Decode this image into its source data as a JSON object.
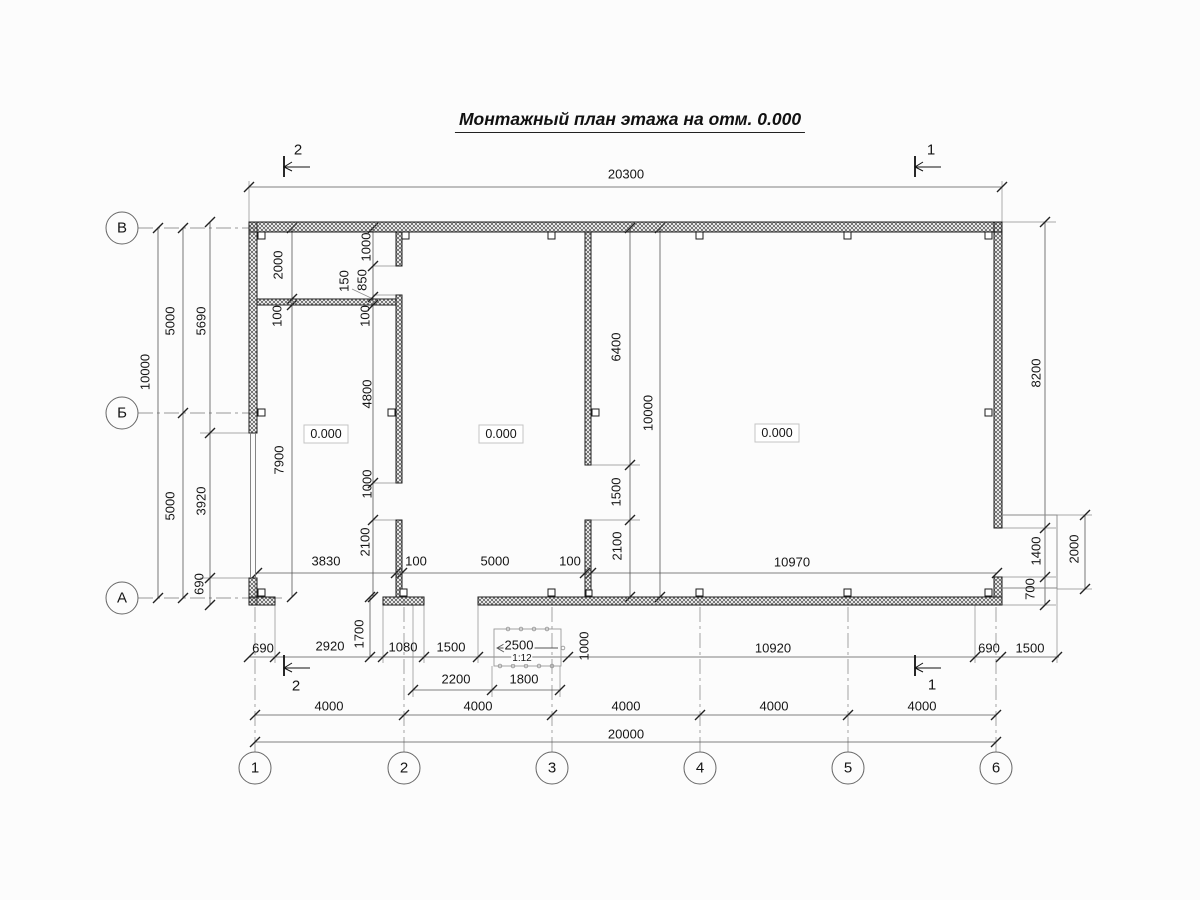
{
  "title": "Монтажный план этажа на отм. 0.000",
  "axis_row_labels": [
    "В",
    "Б",
    "А"
  ],
  "axis_col_labels": [
    "1",
    "2",
    "3",
    "4",
    "5",
    "6"
  ],
  "section_marks": {
    "top_left": "2",
    "top_right": "1",
    "bottom_left": "2",
    "bottom_right": "1"
  },
  "room_levels": [
    "0.000",
    "0.000",
    "0.000"
  ],
  "ramp": {
    "length": "2500",
    "slope": "1:12",
    "width": "1000"
  },
  "overall": {
    "top_width": "20300",
    "bottom_width": "20000",
    "left_height": "10000"
  },
  "labels": [
    {
      "name": "dim-top-20300",
      "text": "20300",
      "x": 626,
      "y": 174,
      "rot": 0,
      "size": 13
    },
    {
      "name": "section-mark-top-left",
      "text": "2",
      "x": 298,
      "y": 150,
      "rot": 0,
      "size": 15
    },
    {
      "name": "section-mark-top-right",
      "text": "1",
      "x": 931,
      "y": 150,
      "rot": 0,
      "size": 15
    },
    {
      "name": "section-mark-bottom-left",
      "text": "2",
      "x": 296,
      "y": 686,
      "rot": 0,
      "size": 15
    },
    {
      "name": "section-mark-bottom-right",
      "text": "1",
      "x": 932,
      "y": 685,
      "rot": 0,
      "size": 15
    },
    {
      "name": "dim-left-10000",
      "text": "10000",
      "x": 145,
      "y": 372,
      "rot": 1,
      "size": 13
    },
    {
      "name": "dim-left-5000-upper",
      "text": "5000",
      "x": 170,
      "y": 321,
      "rot": 1,
      "size": 13
    },
    {
      "name": "dim-left-5000-lower",
      "text": "5000",
      "x": 170,
      "y": 506,
      "rot": 1,
      "size": 13
    },
    {
      "name": "dim-left-5690",
      "text": "5690",
      "x": 201,
      "y": 321,
      "rot": 1,
      "size": 13
    },
    {
      "name": "dim-left-3920",
      "text": "3920",
      "x": 201,
      "y": 501,
      "rot": 1,
      "size": 13
    },
    {
      "name": "dim-left-690",
      "text": "690",
      "x": 199,
      "y": 584,
      "rot": 1,
      "size": 13
    },
    {
      "name": "dim-room1-2000",
      "text": "2000",
      "x": 278,
      "y": 265,
      "rot": 1,
      "size": 13
    },
    {
      "name": "dim-room1-100-left",
      "text": "100",
      "x": 277,
      "y": 316,
      "rot": 1,
      "size": 13
    },
    {
      "name": "dim-room1-7900",
      "text": "7900",
      "x": 279,
      "y": 460,
      "rot": 1,
      "size": 13
    },
    {
      "name": "dim-room1-1000-top",
      "text": "1000",
      "x": 366,
      "y": 247,
      "rot": 1,
      "size": 13
    },
    {
      "name": "dim-room1-850",
      "text": "850",
      "x": 362,
      "y": 280,
      "rot": 1,
      "size": 13
    },
    {
      "name": "dim-room1-150",
      "text": "150",
      "x": 344,
      "y": 281,
      "rot": 1,
      "size": 13
    },
    {
      "name": "dim-room1-100-right",
      "text": "100",
      "x": 365,
      "y": 316,
      "rot": 1,
      "size": 13
    },
    {
      "name": "dim-room1-4800",
      "text": "4800",
      "x": 367,
      "y": 394,
      "rot": 1,
      "size": 13
    },
    {
      "name": "dim-room1-1000-bottom",
      "text": "1000",
      "x": 367,
      "y": 484,
      "rot": 1,
      "size": 13
    },
    {
      "name": "dim-room1-2100",
      "text": "2100",
      "x": 365,
      "y": 542,
      "rot": 1,
      "size": 13
    },
    {
      "name": "dim-room3-6400",
      "text": "6400",
      "x": 616,
      "y": 347,
      "rot": 1,
      "size": 13
    },
    {
      "name": "dim-room3-1500",
      "text": "1500",
      "x": 616,
      "y": 492,
      "rot": 1,
      "size": 13
    },
    {
      "name": "dim-room3-2100",
      "text": "2100",
      "x": 617,
      "y": 546,
      "rot": 1,
      "size": 13
    },
    {
      "name": "dim-room3-10000",
      "text": "10000",
      "x": 648,
      "y": 413,
      "rot": 1,
      "size": 13
    },
    {
      "name": "dim-right-8200",
      "text": "8200",
      "x": 1036,
      "y": 373,
      "rot": 1,
      "size": 13
    },
    {
      "name": "dim-right-1400",
      "text": "1400",
      "x": 1036,
      "y": 551,
      "rot": 1,
      "size": 13
    },
    {
      "name": "dim-right-700",
      "text": "700",
      "x": 1030,
      "y": 589,
      "rot": 1,
      "size": 13
    },
    {
      "name": "dim-right-2000",
      "text": "2000",
      "x": 1074,
      "y": 549,
      "rot": 1,
      "size": 13
    },
    {
      "name": "dim-inner-3830",
      "text": "3830",
      "x": 326,
      "y": 561,
      "rot": 0,
      "size": 13
    },
    {
      "name": "dim-inner-100-left",
      "text": "100",
      "x": 416,
      "y": 561,
      "rot": 0,
      "size": 13
    },
    {
      "name": "dim-inner-5000",
      "text": "5000",
      "x": 495,
      "y": 561,
      "rot": 0,
      "size": 13
    },
    {
      "name": "dim-inner-100-right",
      "text": "100",
      "x": 570,
      "y": 561,
      "rot": 0,
      "size": 13
    },
    {
      "name": "dim-inner-10970",
      "text": "10970",
      "x": 792,
      "y": 562,
      "rot": 0,
      "size": 13
    },
    {
      "name": "room-level-1",
      "text": "0.000",
      "x": 326,
      "y": 434,
      "rot": 0,
      "size": 12.5
    },
    {
      "name": "room-level-2",
      "text": "0.000",
      "x": 501,
      "y": 434,
      "rot": 0,
      "size": 12.5
    },
    {
      "name": "room-level-3",
      "text": "0.000",
      "x": 777,
      "y": 433,
      "rot": 0,
      "size": 12.5
    },
    {
      "name": "dim-bottom-690-left",
      "text": "690",
      "x": 263,
      "y": 648,
      "rot": 0,
      "size": 13
    },
    {
      "name": "dim-bottom-2920",
      "text": "2920",
      "x": 330,
      "y": 646,
      "rot": 0,
      "size": 13
    },
    {
      "name": "dim-bottom-1080",
      "text": "1080",
      "x": 403,
      "y": 647,
      "rot": 0,
      "size": 13
    },
    {
      "name": "dim-bottom-1500-left",
      "text": "1500",
      "x": 451,
      "y": 647,
      "rot": 0,
      "size": 13
    },
    {
      "name": "ramp-length-2500",
      "text": "2500",
      "x": 519,
      "y": 645,
      "rot": 0,
      "size": 13,
      "bg": 1
    },
    {
      "name": "ramp-slope-note",
      "text": "1:12",
      "x": 522,
      "y": 659,
      "rot": 0,
      "size": 10,
      "bg": 1
    },
    {
      "name": "dim-bottom-10920",
      "text": "10920",
      "x": 773,
      "y": 648,
      "rot": 0,
      "size": 13
    },
    {
      "name": "dim-bottom-690-right",
      "text": "690",
      "x": 989,
      "y": 648,
      "rot": 0,
      "size": 13
    },
    {
      "name": "dim-bottom-1500-right",
      "text": "1500",
      "x": 1030,
      "y": 648,
      "rot": 0,
      "size": 13
    },
    {
      "name": "dim-bottom-1700",
      "text": "1700",
      "x": 359,
      "y": 634,
      "rot": 1,
      "size": 13
    },
    {
      "name": "ramp-width-1000",
      "text": "1000",
      "x": 584,
      "y": 646,
      "rot": 1,
      "size": 13
    },
    {
      "name": "dim-bottom-2200",
      "text": "2200",
      "x": 456,
      "y": 679,
      "rot": 0,
      "size": 13
    },
    {
      "name": "dim-bottom-1800",
      "text": "1800",
      "x": 524,
      "y": 679,
      "rot": 0,
      "size": 13
    },
    {
      "name": "dim-grid-4000-1",
      "text": "4000",
      "x": 329,
      "y": 706,
      "rot": 0,
      "size": 13
    },
    {
      "name": "dim-grid-4000-2",
      "text": "4000",
      "x": 478,
      "y": 706,
      "rot": 0,
      "size": 13
    },
    {
      "name": "dim-grid-4000-3",
      "text": "4000",
      "x": 626,
      "y": 706,
      "rot": 0,
      "size": 13
    },
    {
      "name": "dim-grid-4000-4",
      "text": "4000",
      "x": 774,
      "y": 706,
      "rot": 0,
      "size": 13
    },
    {
      "name": "dim-grid-4000-5",
      "text": "4000",
      "x": 922,
      "y": 706,
      "rot": 0,
      "size": 13
    },
    {
      "name": "dim-grid-20000",
      "text": "20000",
      "x": 626,
      "y": 734,
      "rot": 0,
      "size": 13
    },
    {
      "name": "axis-row-v",
      "text": "В",
      "x": 122,
      "y": 228,
      "rot": 0,
      "size": 15
    },
    {
      "name": "axis-row-b",
      "text": "Б",
      "x": 122,
      "y": 413,
      "rot": 0,
      "size": 15
    },
    {
      "name": "axis-row-a",
      "text": "А",
      "x": 122,
      "y": 598,
      "rot": 0,
      "size": 15
    },
    {
      "name": "axis-col-1",
      "text": "1",
      "x": 255,
      "y": 768,
      "rot": 0,
      "size": 15
    },
    {
      "name": "axis-col-2",
      "text": "2",
      "x": 404,
      "y": 768,
      "rot": 0,
      "size": 15
    },
    {
      "name": "axis-col-3",
      "text": "3",
      "x": 552,
      "y": 768,
      "rot": 0,
      "size": 15
    },
    {
      "name": "axis-col-4",
      "text": "4",
      "x": 700,
      "y": 768,
      "rot": 0,
      "size": 15
    },
    {
      "name": "axis-col-5",
      "text": "5",
      "x": 848,
      "y": 768,
      "rot": 0,
      "size": 15
    },
    {
      "name": "axis-col-6",
      "text": "6",
      "x": 996,
      "y": 768,
      "rot": 0,
      "size": 15
    }
  ]
}
